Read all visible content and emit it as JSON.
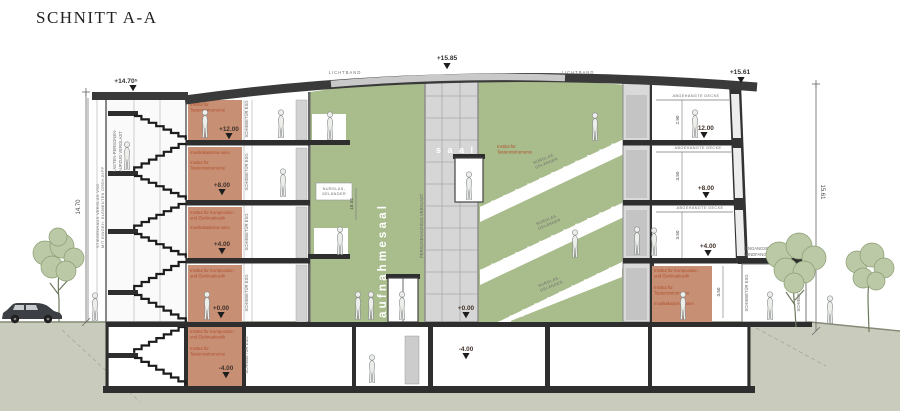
{
  "title": "SCHNITT A-A",
  "colors": {
    "hall_green": "#a9bc8c",
    "room_orange": "#c78f74",
    "roof_dark": "#3a3a3a",
    "ground": "#c9ccbd",
    "label_orange": "#b14f2e",
    "tree_green": "#bcc9a6"
  },
  "elevations": {
    "roof_center": "+15.85",
    "roof_right": "+15.61",
    "tower_roof": "+14.70⁵",
    "level3": "+12.00",
    "level2": "+8.00",
    "level1": "+4.00",
    "ground": "+0.00",
    "basement": "-4.00"
  },
  "dimensions": {
    "left_total": "14.70",
    "right_total": "15.61",
    "hall_height": "15.44",
    "top_room": "2.90",
    "mid_room": "3.50",
    "low_room": "3.50",
    "ground_room": "3.50"
  },
  "labels": {
    "lichtband": "LICHTBAND",
    "nurglas_line1": "NURGLAS-",
    "nurglas_line2": "GELÄNDER",
    "schiebetuer": "SCHIEBETÜR ESG",
    "abgehaengte_decke": "ABGEHÄNGTE DECKE",
    "eingang_line1": "EINGANGSBEREICH",
    "eingang_line2": "WINDFANG VERGLAS VSG",
    "personenaufzug": "PERSONENAUFZUG VERGLAST",
    "lastenaufzug_line1": "LASTEN-PERSONEN-",
    "lastenaufzug_line2": "AUFZUG VERGLAST",
    "stiegenhaus_line1": "STIEGENHAUS VERGLAS VSG",
    "stiegenhaus_line2": "MIT EINGEH. ELEMENTEN DREH-KIPP",
    "aufnahmesaal": "aufnahmesaal",
    "saal": "s a a l",
    "inst_tasten_line1": "Institut für",
    "inst_tasten_line2": "Tasteninstrumente",
    "inst_komp_line1": "Institut für Komposition",
    "inst_komp_line2": "und Elektroakustik",
    "akademie": "musikakademie wien"
  }
}
